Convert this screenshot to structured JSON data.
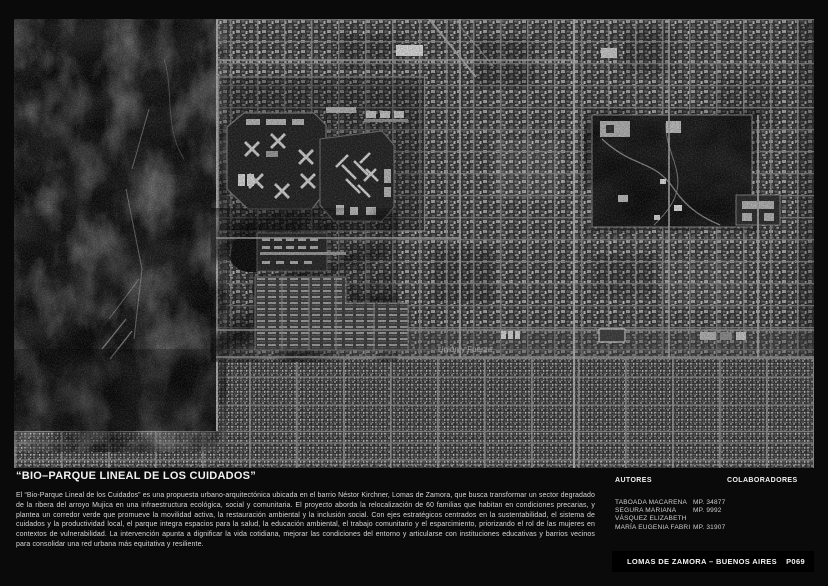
{
  "page": {
    "title": "“BIO–PARQUE LINEAL DE LOS CUIDADOS”",
    "description": "El “Bio-Parque Lineal de los Cuidados” es una propuesta urbano-arquitectónica ubicada en el barrio Néstor Kirchner, Lomas de Zamora, que busca transformar un sector degradado de la ribera del arroyo Mujica en una infraestructura ecológica, social y comunitaria. El proyecto aborda la relocalización de 60 familias que habitan en condiciones precarias, y plantea un corredor verde que promueve la movilidad activa, la restauración ambiental y la inclusión social. Con ejes estratégicos centrados en la sustentabilidad, el sistema de cuidados y la productividad local, el parque integra espacios para la salud, la educación ambiental, el trabajo comunitario y el esparcimiento, priorizando el rol de las mujeres en contextos de vulnerabilidad. La intervención apunta a dignificar la vida cotidiana, mejorar las condiciones del entorno y articularse con instituciones educativas y barrios vecinos para consolidar una red urbana más equitativa y resiliente."
  },
  "credits": {
    "autores_label": "AUTORES",
    "colaboradores_label": "COLABORADORES",
    "autores": [
      {
        "name": "TABOADA MACARENA",
        "mp": "MP. 34877"
      },
      {
        "name": "SEGURA MARIANA",
        "mp": "MP. 9992"
      },
      {
        "name": "VÁSQUEZ ELIZABETH",
        "mp": ""
      },
      {
        "name": "MARÍA EUGENIA FABRI",
        "mp": "MP. 31907"
      }
    ]
  },
  "footer": {
    "location": "LOMAS DE ZAMORA – BUENOS AIRES",
    "page_number": "P069"
  },
  "map": {
    "label": "Unión y Fuerza"
  },
  "colors": {
    "background": "#0a0a0a",
    "bar_background": "#000000",
    "text": "#f0f0f0",
    "muted_text": "#cfcfcf"
  }
}
